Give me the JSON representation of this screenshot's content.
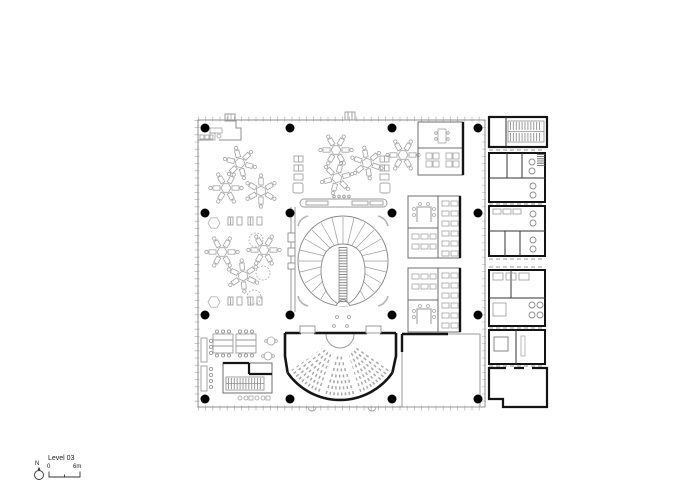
{
  "drawing": {
    "kind": "architectural-floor-plan",
    "elements": [
      "open-office-desk-clusters",
      "central-spiral-stair-atrium",
      "auditorium",
      "meeting-rooms",
      "service-core-with-stairs-and-wc",
      "column-grid"
    ]
  },
  "legend": {
    "north_label": "N",
    "level_label": "Level 03",
    "scale_zero": "0",
    "scale_six": "6m"
  },
  "colors": {
    "background": "#ffffff",
    "heavy_wall": "#141414",
    "partition": "#6e6e6e",
    "furniture": "#a3a3a3",
    "facade": "#8f8f8f",
    "column_dot": "#000000",
    "text": "#1a1a1a"
  }
}
